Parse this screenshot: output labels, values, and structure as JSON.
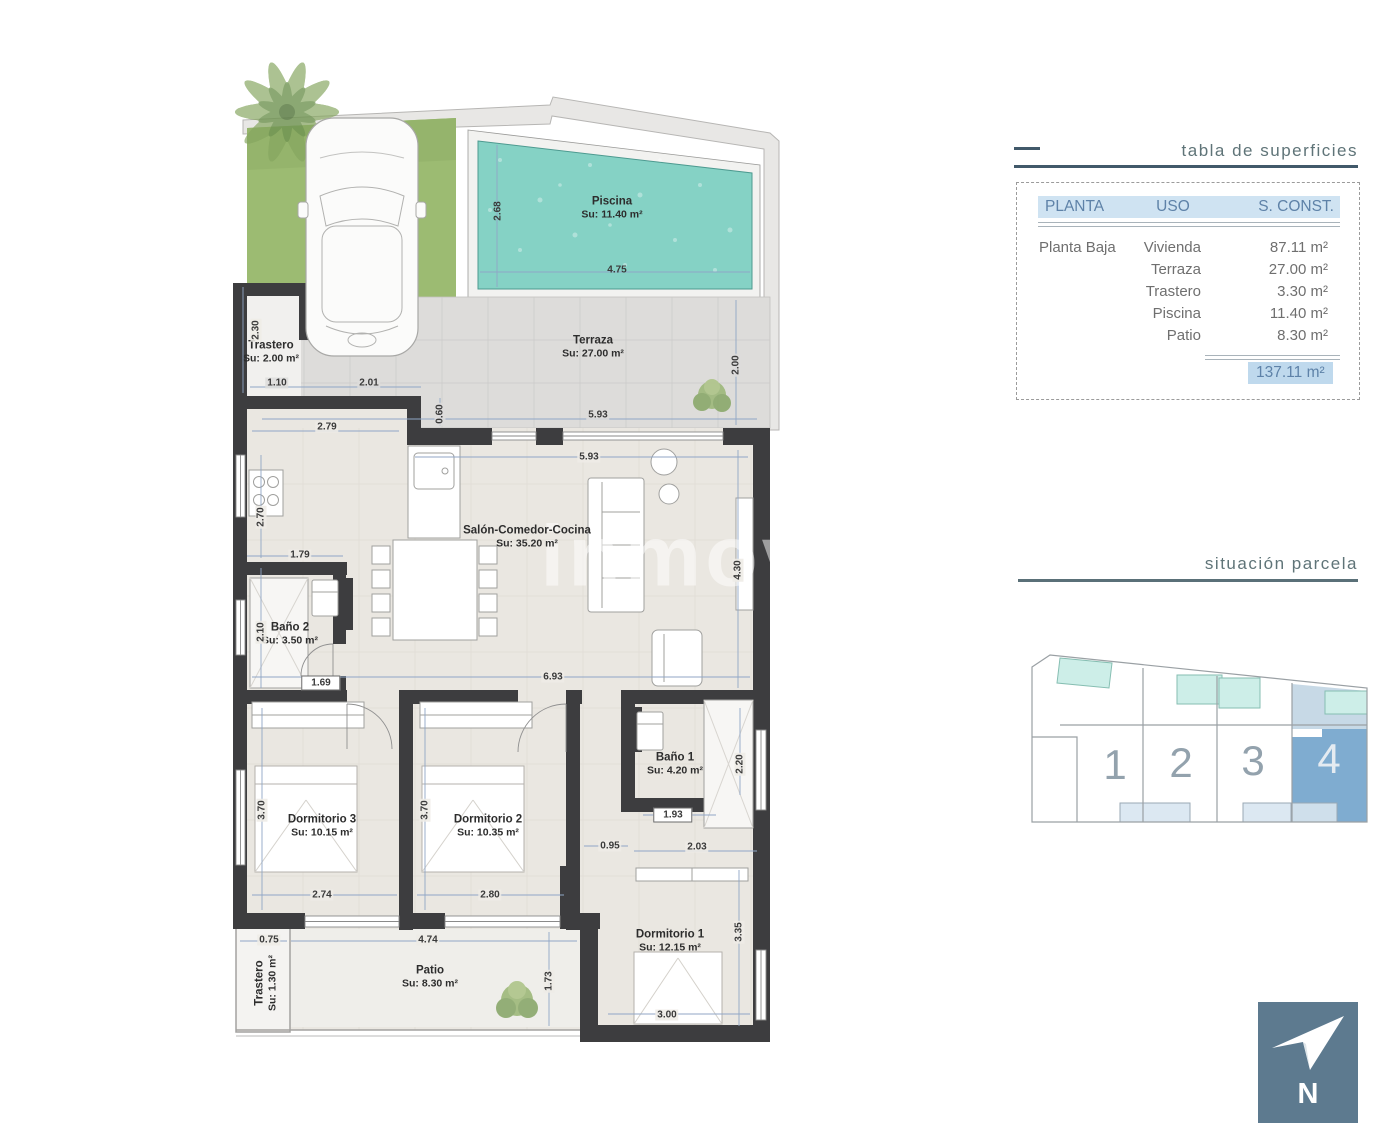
{
  "watermark": "inmov",
  "panel": {
    "surface_table": {
      "title": "tabla de superficies",
      "headers": {
        "planta": "PLANTA",
        "uso": "USO",
        "sconst": "S. CONST."
      },
      "floor_label": "Planta Baja",
      "rows": [
        {
          "uso": "Vivienda",
          "sup": "87.11 m²"
        },
        {
          "uso": "Terraza",
          "sup": "27.00 m²"
        },
        {
          "uso": "Trastero",
          "sup": "3.30 m²"
        },
        {
          "uso": "Piscina",
          "sup": "11.40 m²"
        },
        {
          "uso": "Patio",
          "sup": "8.30 m²"
        }
      ],
      "total": "137.11 m²"
    },
    "plot_location": {
      "title": "situación parcela",
      "units": [
        {
          "n": "1"
        },
        {
          "n": "2"
        },
        {
          "n": "3"
        },
        {
          "n": "4"
        }
      ],
      "highlighted": "4"
    }
  },
  "north": {
    "label": "N"
  },
  "plan": {
    "rooms": [
      {
        "name": "Piscina",
        "area": "Su: 11.40 m²"
      },
      {
        "name": "Terraza",
        "area": "Su: 27.00 m²"
      },
      {
        "name": "Trastero",
        "area": "Su: 2.00 m²"
      },
      {
        "name": "Salón-Comedor-Cocina",
        "area": "Su: 35.20 m²"
      },
      {
        "name": "Baño 2",
        "area": "Su: 3.50 m²"
      },
      {
        "name": "Dormitorio 3",
        "area": "Su: 10.15 m²"
      },
      {
        "name": "Dormitorio 2",
        "area": "Su: 10.35 m²"
      },
      {
        "name": "Baño 1",
        "area": "Su: 4.20 m²"
      },
      {
        "name": "Dormitorio 1",
        "area": "Su: 12.15 m²"
      },
      {
        "name": "Patio",
        "area": "Su: 8.30 m²"
      },
      {
        "name": "Trastero",
        "area": "Su: 1.30 m²"
      }
    ],
    "dims": [
      "2.68",
      "4.75",
      "2.30",
      "1.10",
      "2.01",
      "5.93",
      "2.00",
      "0.60",
      "2.79",
      "5.93",
      "2.70",
      "1.79",
      "4.30",
      "2.10",
      "1.69",
      "6.93",
      "2.20",
      "3.70",
      "3.70",
      "0.95",
      "1.93",
      "2.03",
      "2.74",
      "2.80",
      "0.75",
      "4.74",
      "3.35",
      "1.73",
      "3.00"
    ]
  },
  "colors": {
    "pool": "#85d2c5",
    "grass": "#9cbb72",
    "wall": "#3d3d3f",
    "unit_highlight": "#7facd0",
    "header_bg": "#cfe3f2",
    "header_text": "#5e82a8",
    "title_text": "#5f7478",
    "total_bg": "#bfd9ed",
    "north_bg": "#5d7a8f"
  }
}
